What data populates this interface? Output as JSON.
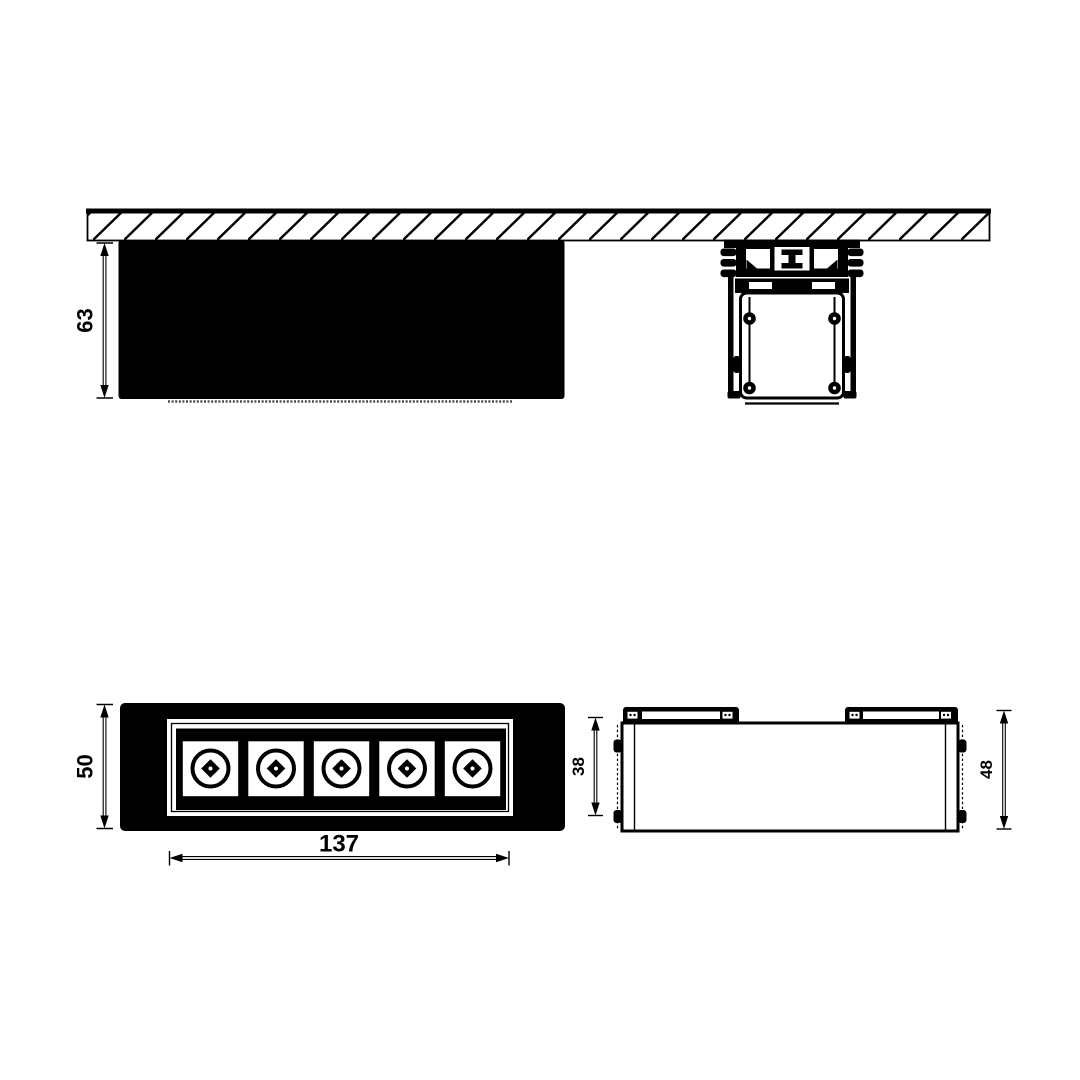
{
  "style": {
    "background": "#ffffff",
    "ink": "#000000"
  },
  "views": {
    "ceiling_section": {
      "recess_depth": "63",
      "corner_screw_count": 4
    },
    "front": {
      "height": "50",
      "width": "137",
      "led_module_count": 5
    },
    "side": {
      "housing_height": "38",
      "overall_height": "48",
      "mounting_clip_count": 2
    }
  }
}
